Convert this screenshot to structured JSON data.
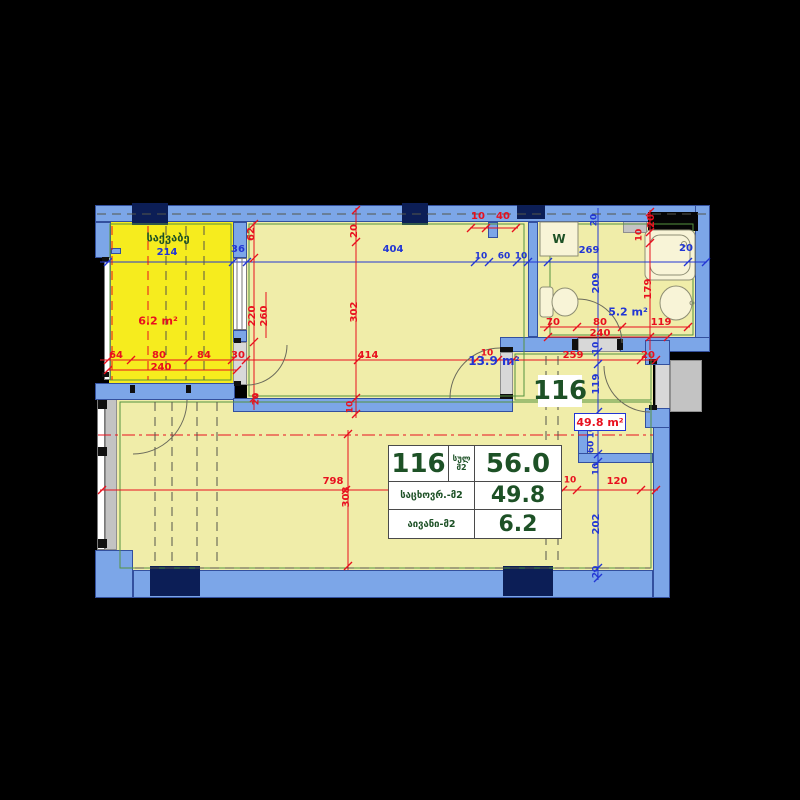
{
  "title": "Apartment 116 floor plan",
  "unit": {
    "number": "116",
    "total_label_line1": "სულ",
    "total_label_line2": "მ2",
    "total_area": "56.0",
    "living_label": "საცხოვრ.-მ2",
    "living_area": "49.8",
    "balcony_label": "აივანი-მ2",
    "balcony_area": "6.2"
  },
  "plan_labels": {
    "unit_box": "116",
    "living_area_box": "49.8 m²"
  },
  "rooms": [
    {
      "name": "საქვაბე",
      "area": "6.2 m²"
    },
    {
      "name": "room",
      "area": "13.9 m²"
    },
    {
      "name": "bathroom",
      "area": "5.2 m²",
      "fixture_label": "W"
    },
    {
      "name": "living-total",
      "area": "49.8 m²"
    }
  ],
  "colors": {
    "bg": "#000000",
    "wall": "#7ca6e8",
    "wallEdge": "#33509e",
    "navy": "#0c1e56",
    "bright": "#f6ec1e",
    "pale": "#f0eda9",
    "cream": "#f8f4d7",
    "white": "#ffffff",
    "gray1": "#d8d8d8",
    "gray2": "#c3c3c3",
    "red": "#e8101e",
    "blue": "#2236d4",
    "green": "#1d5126",
    "greenLine": "#55923f",
    "dark": "#55554a",
    "arc": "#6b6b5c",
    "fixStroke": "#8e8e74",
    "win": "#777777"
  },
  "drawing": {
    "fills": [
      {
        "x": 109,
        "y": 222,
        "w": 124,
        "h": 161,
        "c": "bright",
        "n": "balcony-floor"
      },
      {
        "x": 247,
        "y": 222,
        "w": 281,
        "h": 176,
        "c": "pale",
        "n": "room-floor"
      },
      {
        "x": 538,
        "y": 222,
        "w": 157,
        "h": 115,
        "c": "pale",
        "n": "bathroom-floor"
      },
      {
        "x": 513,
        "y": 352,
        "w": 140,
        "h": 60,
        "c": "pale",
        "n": "corridor-floor"
      },
      {
        "x": 116,
        "y": 398,
        "w": 537,
        "h": 172,
        "c": "pale",
        "n": "living-floor"
      }
    ],
    "glass": [
      {
        "x": 104,
        "y": 252,
        "w": 7,
        "h": 128,
        "c": "white",
        "n": "balcony-railing"
      },
      {
        "x": 233,
        "y": 258,
        "w": 14,
        "h": 72,
        "c": "white",
        "n": "balcony-window"
      },
      {
        "x": 97,
        "y": 398,
        "w": 8,
        "h": 152,
        "c": "white",
        "n": "living-window-outer"
      },
      {
        "x": 105,
        "y": 398,
        "w": 12,
        "h": 152,
        "c": "gray2",
        "n": "living-window-inner"
      },
      {
        "x": 133,
        "y": 385,
        "w": 57,
        "h": 15,
        "c": "gray1",
        "n": "balcony-door-threshold"
      },
      {
        "x": 233,
        "y": 342,
        "w": 14,
        "h": 43,
        "c": "gray1",
        "n": "balcony-partition-door"
      },
      {
        "x": 500,
        "y": 352,
        "w": 13,
        "h": 44,
        "c": "gray1",
        "n": "room-door-opening"
      },
      {
        "x": 578,
        "y": 338,
        "w": 42,
        "h": 14,
        "c": "gray1",
        "n": "bathroom-door-opening"
      },
      {
        "x": 655,
        "y": 363,
        "w": 15,
        "h": 47,
        "c": "gray1",
        "n": "entrance-door-opening"
      },
      {
        "x": 670,
        "y": 360,
        "w": 32,
        "h": 52,
        "c": "gray2",
        "n": "entrance-landing"
      },
      {
        "x": 623,
        "y": 212,
        "w": 24,
        "h": 21,
        "c": "gray2",
        "n": "vent-shaft"
      }
    ],
    "walls": [
      [
        95,
        205,
        615,
        17
      ],
      [
        695,
        205,
        15,
        147
      ],
      [
        620,
        337,
        90,
        15
      ],
      [
        500,
        337,
        78,
        15
      ],
      [
        528,
        222,
        10,
        115
      ],
      [
        488,
        222,
        10,
        16
      ],
      [
        233,
        222,
        14,
        36
      ],
      [
        233,
        330,
        14,
        12
      ],
      [
        95,
        383,
        140,
        17
      ],
      [
        233,
        398,
        280,
        14
      ],
      [
        578,
        415,
        10,
        40
      ],
      [
        578,
        453,
        75,
        10
      ],
      [
        653,
        425,
        17,
        173
      ],
      [
        645,
        340,
        25,
        25
      ],
      [
        645,
        408,
        25,
        20
      ],
      [
        133,
        570,
        520,
        28
      ],
      [
        95,
        550,
        38,
        48
      ],
      [
        95,
        222,
        16,
        36
      ],
      [
        111,
        248,
        10,
        6
      ]
    ],
    "navy": [
      [
        132,
        203,
        36,
        22
      ],
      [
        402,
        203,
        26,
        22
      ],
      [
        517,
        205,
        28,
        14
      ],
      [
        150,
        566,
        50,
        30
      ],
      [
        503,
        566,
        50,
        30
      ]
    ],
    "blacks": [
      [
        648,
        212,
        50,
        19
      ]
    ],
    "stops": [
      [
        130,
        385,
        5,
        8
      ],
      [
        186,
        385,
        5,
        8
      ],
      [
        234,
        338,
        7,
        5
      ],
      [
        234,
        381,
        7,
        5
      ],
      [
        500,
        347,
        13,
        5
      ],
      [
        500,
        394,
        13,
        5
      ],
      [
        572,
        339,
        6,
        11
      ],
      [
        617,
        339,
        6,
        11
      ],
      [
        649,
        359,
        8,
        5
      ],
      [
        649,
        405,
        8,
        5
      ],
      [
        98,
        400,
        9,
        9
      ],
      [
        98,
        447,
        9,
        9
      ],
      [
        98,
        539,
        9,
        9
      ],
      [
        102,
        257,
        7,
        5
      ],
      [
        102,
        372,
        7,
        5
      ]
    ],
    "green_outlines": [
      [
        110,
        224,
        121,
        156
      ],
      [
        249,
        224,
        275,
        172
      ],
      [
        550,
        224,
        143,
        111
      ],
      [
        120,
        402,
        531,
        166
      ],
      [
        515,
        354,
        136,
        46
      ]
    ],
    "fixtures": [
      {
        "k": "rect",
        "x": 645,
        "y": 230,
        "w": 50,
        "h": 50,
        "rx": 6,
        "f": 1,
        "n": "bathtub"
      },
      {
        "k": "rect",
        "x": 650,
        "y": 235,
        "w": 40,
        "h": 40,
        "rx": 10,
        "f": 0,
        "n": "bathtub-inner"
      },
      {
        "k": "circle",
        "cx": 684,
        "cy": 244,
        "r": 2.5,
        "f": 0,
        "n": "bathtub-drain"
      },
      {
        "k": "ellipse",
        "cx": 676,
        "cy": 303,
        "rx": 16,
        "ry": 17,
        "f": 1,
        "n": "sink"
      },
      {
        "k": "circle",
        "cx": 692,
        "cy": 303,
        "r": 2,
        "f": 0,
        "n": "sink-tap"
      },
      {
        "k": "rect",
        "x": 540,
        "y": 287,
        "w": 13,
        "h": 30,
        "rx": 3,
        "f": 1,
        "n": "toilet-tank"
      },
      {
        "k": "ellipse",
        "cx": 565,
        "cy": 302,
        "rx": 13,
        "ry": 14,
        "f": 1,
        "n": "toilet-bowl"
      },
      {
        "k": "rect",
        "x": 540,
        "y": 222,
        "w": 38,
        "h": 34,
        "rx": 0,
        "f": 1,
        "n": "washing-machine"
      }
    ],
    "lines": [
      [
        100,
        262,
        707,
        262,
        "b"
      ],
      [
        598,
        208,
        598,
        580,
        "b"
      ],
      [
        100,
        360,
        658,
        360,
        "r"
      ],
      [
        108,
        370,
        237,
        370,
        "r"
      ],
      [
        540,
        327,
        690,
        327,
        "r"
      ],
      [
        548,
        337,
        668,
        337,
        "r"
      ],
      [
        100,
        490,
        658,
        490,
        "r"
      ],
      [
        356,
        208,
        356,
        418,
        "r"
      ],
      [
        254,
        222,
        254,
        410,
        "r"
      ],
      [
        266,
        292,
        266,
        338,
        "r"
      ],
      [
        348,
        430,
        348,
        570,
        "r"
      ],
      [
        650,
        210,
        650,
        350,
        "r"
      ],
      [
        470,
        228,
        518,
        228,
        "r"
      ],
      [
        98,
        435,
        653,
        435,
        "r",
        "dd"
      ],
      [
        135,
        568,
        650,
        568,
        "k",
        "d"
      ],
      [
        97,
        214,
        708,
        214,
        "k",
        "d"
      ],
      [
        155,
        402,
        155,
        566,
        "k",
        "d"
      ],
      [
        172,
        402,
        172,
        566,
        "k",
        "d"
      ],
      [
        197,
        402,
        197,
        566,
        "k",
        "d"
      ],
      [
        217,
        402,
        217,
        566,
        "k",
        "d"
      ],
      [
        546,
        356,
        546,
        566,
        "k",
        "d"
      ],
      [
        558,
        356,
        558,
        566,
        "k",
        "d"
      ],
      [
        112,
        226,
        112,
        380,
        "r",
        "d"
      ],
      [
        148,
        226,
        148,
        380,
        "r",
        "d"
      ],
      [
        166,
        226,
        166,
        380,
        "k",
        "d"
      ],
      [
        186,
        226,
        186,
        380,
        "k",
        "d"
      ],
      [
        204,
        226,
        204,
        380,
        "k",
        "d"
      ],
      [
        237,
        258,
        237,
        330,
        "w"
      ],
      [
        242,
        258,
        242,
        330,
        "w"
      ]
    ],
    "arcs": [
      "M287,345 A40 40 0 0 1 247,385",
      "M187,400 A54 54 0 0 1 133,454",
      "M450,398 A50 50 0 0 1 500,348",
      "M578,299 A44 44 0 0 1 622,343",
      "M604,366 A46 46 0 0 0 650,412"
    ],
    "ticks": [
      [
        108,
        262,
        "b"
      ],
      [
        233,
        262,
        "b"
      ],
      [
        247,
        262,
        "b"
      ],
      [
        475,
        262,
        "b"
      ],
      [
        489,
        262,
        "b"
      ],
      [
        517,
        262,
        "b"
      ],
      [
        528,
        262,
        "b"
      ],
      [
        548,
        262,
        "b"
      ],
      [
        688,
        262,
        "b"
      ],
      [
        706,
        262,
        "b"
      ],
      [
        108,
        360,
        "r"
      ],
      [
        131,
        360,
        "r"
      ],
      [
        188,
        360,
        "r"
      ],
      [
        232,
        360,
        "r"
      ],
      [
        246,
        360,
        "r"
      ],
      [
        358,
        360,
        "r"
      ],
      [
        476,
        360,
        "r"
      ],
      [
        498,
        360,
        "r"
      ],
      [
        513,
        360,
        "r"
      ],
      [
        641,
        360,
        "r"
      ],
      [
        656,
        360,
        "r"
      ],
      [
        108,
        370,
        "r"
      ],
      [
        237,
        370,
        "r"
      ],
      [
        548,
        327,
        "r"
      ],
      [
        577,
        327,
        "r"
      ],
      [
        622,
        327,
        "r"
      ],
      [
        688,
        327,
        "r"
      ],
      [
        548,
        337,
        "r"
      ],
      [
        668,
        337,
        "r"
      ],
      [
        102,
        490,
        "r"
      ],
      [
        346,
        490,
        "r"
      ],
      [
        563,
        490,
        "r"
      ],
      [
        577,
        490,
        "r"
      ],
      [
        641,
        490,
        "r"
      ],
      [
        656,
        490,
        "r"
      ],
      [
        471,
        228,
        "r"
      ],
      [
        486,
        228,
        "r"
      ],
      [
        516,
        228,
        "r"
      ],
      [
        598,
        352,
        "b"
      ],
      [
        598,
        364,
        "b"
      ],
      [
        598,
        412,
        "b"
      ],
      [
        598,
        426,
        "b"
      ],
      [
        598,
        454,
        "b"
      ],
      [
        598,
        462,
        "b"
      ],
      [
        598,
        568,
        "b"
      ],
      [
        598,
        578,
        "b"
      ],
      [
        356,
        210,
        "r"
      ],
      [
        356,
        242,
        "r"
      ],
      [
        356,
        398,
        "r"
      ],
      [
        356,
        414,
        "r"
      ],
      [
        254,
        224,
        "r"
      ],
      [
        254,
        258,
        "r"
      ],
      [
        254,
        342,
        "r"
      ],
      [
        254,
        398,
        "r"
      ],
      [
        650,
        212,
        "r"
      ],
      [
        650,
        232,
        "r"
      ],
      [
        650,
        243,
        "r"
      ],
      [
        650,
        337,
        "r"
      ],
      [
        348,
        434,
        "r"
      ],
      [
        348,
        566,
        "r"
      ]
    ],
    "labels": [
      [
        "საქვაბე",
        168,
        238,
        "g",
        11,
        0,
        "room-label-boiler"
      ],
      [
        "214",
        167,
        253,
        "b",
        10,
        0
      ],
      [
        "6.2 m²",
        158,
        321,
        "r",
        11,
        0,
        "area-label-balcony"
      ],
      [
        "W",
        559,
        239,
        "g",
        12,
        0,
        "washing-machine-label"
      ],
      [
        "13.9 m²",
        494,
        361,
        "b",
        12,
        0,
        "area-label-room"
      ],
      [
        "5.2 m²",
        628,
        312,
        "b",
        11,
        0,
        "area-label-bathroom"
      ],
      [
        "36",
        238,
        250,
        "b",
        10,
        0
      ],
      [
        "404",
        393,
        250,
        "b",
        10,
        0
      ],
      [
        "10",
        481,
        257,
        "b",
        9,
        0
      ],
      [
        "60",
        504,
        257,
        "b",
        9,
        0
      ],
      [
        "10",
        521,
        257,
        "b",
        9,
        0
      ],
      [
        "269",
        589,
        251,
        "b",
        10,
        0
      ],
      [
        "20",
        686,
        249,
        "b",
        10,
        0
      ],
      [
        "20",
        595,
        220,
        "b",
        9,
        1
      ],
      [
        "209",
        597,
        283,
        "b",
        10,
        1
      ],
      [
        "10",
        597,
        348,
        "b",
        9,
        1
      ],
      [
        "119",
        597,
        384,
        "b",
        10,
        1
      ],
      [
        "10",
        592,
        432,
        "b",
        9,
        1
      ],
      [
        "60",
        592,
        447,
        "b",
        9,
        1
      ],
      [
        "10",
        597,
        469,
        "b",
        9,
        1
      ],
      [
        "202",
        597,
        524,
        "b",
        10,
        1
      ],
      [
        "20",
        597,
        572,
        "b",
        9,
        1
      ],
      [
        "20",
        355,
        231,
        "r",
        10,
        1
      ],
      [
        "302",
        355,
        312,
        "r",
        10,
        1
      ],
      [
        "10",
        351,
        407,
        "r",
        9,
        1
      ],
      [
        "62",
        252,
        234,
        "r",
        10,
        1
      ],
      [
        "220",
        253,
        316,
        "r",
        10,
        1
      ],
      [
        "260",
        265,
        316,
        "r",
        10,
        1
      ],
      [
        "20",
        257,
        399,
        "r",
        9,
        1
      ],
      [
        "64",
        116,
        356,
        "r",
        10,
        0
      ],
      [
        "80",
        159,
        356,
        "r",
        10,
        0
      ],
      [
        "84",
        204,
        356,
        "r",
        10,
        0
      ],
      [
        "30",
        238,
        356,
        "r",
        10,
        0
      ],
      [
        "240",
        161,
        368,
        "r",
        10,
        0
      ],
      [
        "414",
        368,
        356,
        "r",
        10,
        0
      ],
      [
        "10",
        487,
        354,
        "r",
        9,
        0
      ],
      [
        "259",
        573,
        356,
        "r",
        10,
        0
      ],
      [
        "20",
        648,
        356,
        "r",
        10,
        0
      ],
      [
        "70",
        553,
        323,
        "r",
        10,
        0
      ],
      [
        "80",
        600,
        323,
        "r",
        10,
        0
      ],
      [
        "119",
        661,
        323,
        "r",
        10,
        0
      ],
      [
        "240",
        600,
        334,
        "r",
        10,
        0
      ],
      [
        "179",
        649,
        289,
        "r",
        10,
        1
      ],
      [
        "10",
        640,
        235,
        "r",
        9,
        1
      ],
      [
        "20",
        652,
        221,
        "r",
        10,
        1
      ],
      [
        "10",
        478,
        217,
        "r",
        10,
        0
      ],
      [
        "40",
        503,
        217,
        "r",
        10,
        0
      ],
      [
        "798",
        333,
        482,
        "r",
        10,
        0
      ],
      [
        "308",
        347,
        497,
        "r",
        10,
        1
      ],
      [
        "10",
        570,
        481,
        "r",
        9,
        0
      ],
      [
        "120",
        617,
        482,
        "r",
        10,
        0
      ]
    ]
  }
}
